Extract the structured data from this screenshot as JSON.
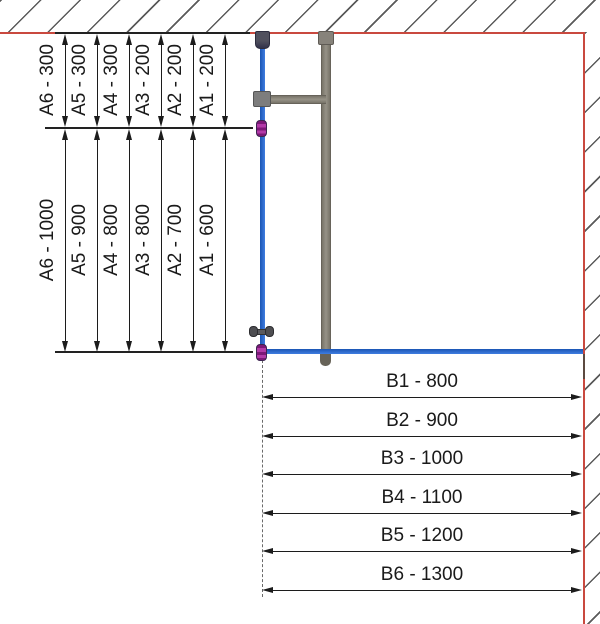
{
  "diagram": {
    "type": "technical-dimension-drawing",
    "series_a_upper": {
      "items": [
        {
          "code": "A6",
          "label": "A6 - 300",
          "value_mm": 300
        },
        {
          "code": "A5",
          "label": "A5 - 300",
          "value_mm": 300
        },
        {
          "code": "A4",
          "label": "A4 - 300",
          "value_mm": 300
        },
        {
          "code": "A3",
          "label": "A3 - 200",
          "value_mm": 200
        },
        {
          "code": "A2",
          "label": "A2 - 200",
          "value_mm": 200
        },
        {
          "code": "A1",
          "label": "A1 - 200",
          "value_mm": 200
        }
      ]
    },
    "series_a_lower": {
      "items": [
        {
          "code": "A6",
          "label": "A6 - 1000",
          "value_mm": 1000
        },
        {
          "code": "A5",
          "label": "A5 - 900",
          "value_mm": 900
        },
        {
          "code": "A4",
          "label": "A4 - 800",
          "value_mm": 800
        },
        {
          "code": "A3",
          "label": "A3 - 800",
          "value_mm": 800
        },
        {
          "code": "A2",
          "label": "A2 - 700",
          "value_mm": 700
        },
        {
          "code": "A1",
          "label": "A1 - 600",
          "value_mm": 600
        }
      ]
    },
    "series_b": {
      "items": [
        {
          "code": "B1",
          "label": "B1 - 800",
          "value_mm": 800
        },
        {
          "code": "B2",
          "label": "B2 - 900",
          "value_mm": 900
        },
        {
          "code": "B3",
          "label": "B3 - 1000",
          "value_mm": 1000
        },
        {
          "code": "B4",
          "label": "B4 - 1100",
          "value_mm": 1100
        },
        {
          "code": "B5",
          "label": "B5 - 1200",
          "value_mm": 1200
        },
        {
          "code": "B6",
          "label": "B6 - 1300",
          "value_mm": 1300
        }
      ]
    },
    "colors": {
      "wall_ceiling_outline": "#c9493f",
      "glass_edge_blue": "#2e6fd6",
      "profile_gray": "#8b8780",
      "connector_purple": "#9c1d94",
      "dimension_black": "#1a1a1a"
    }
  }
}
